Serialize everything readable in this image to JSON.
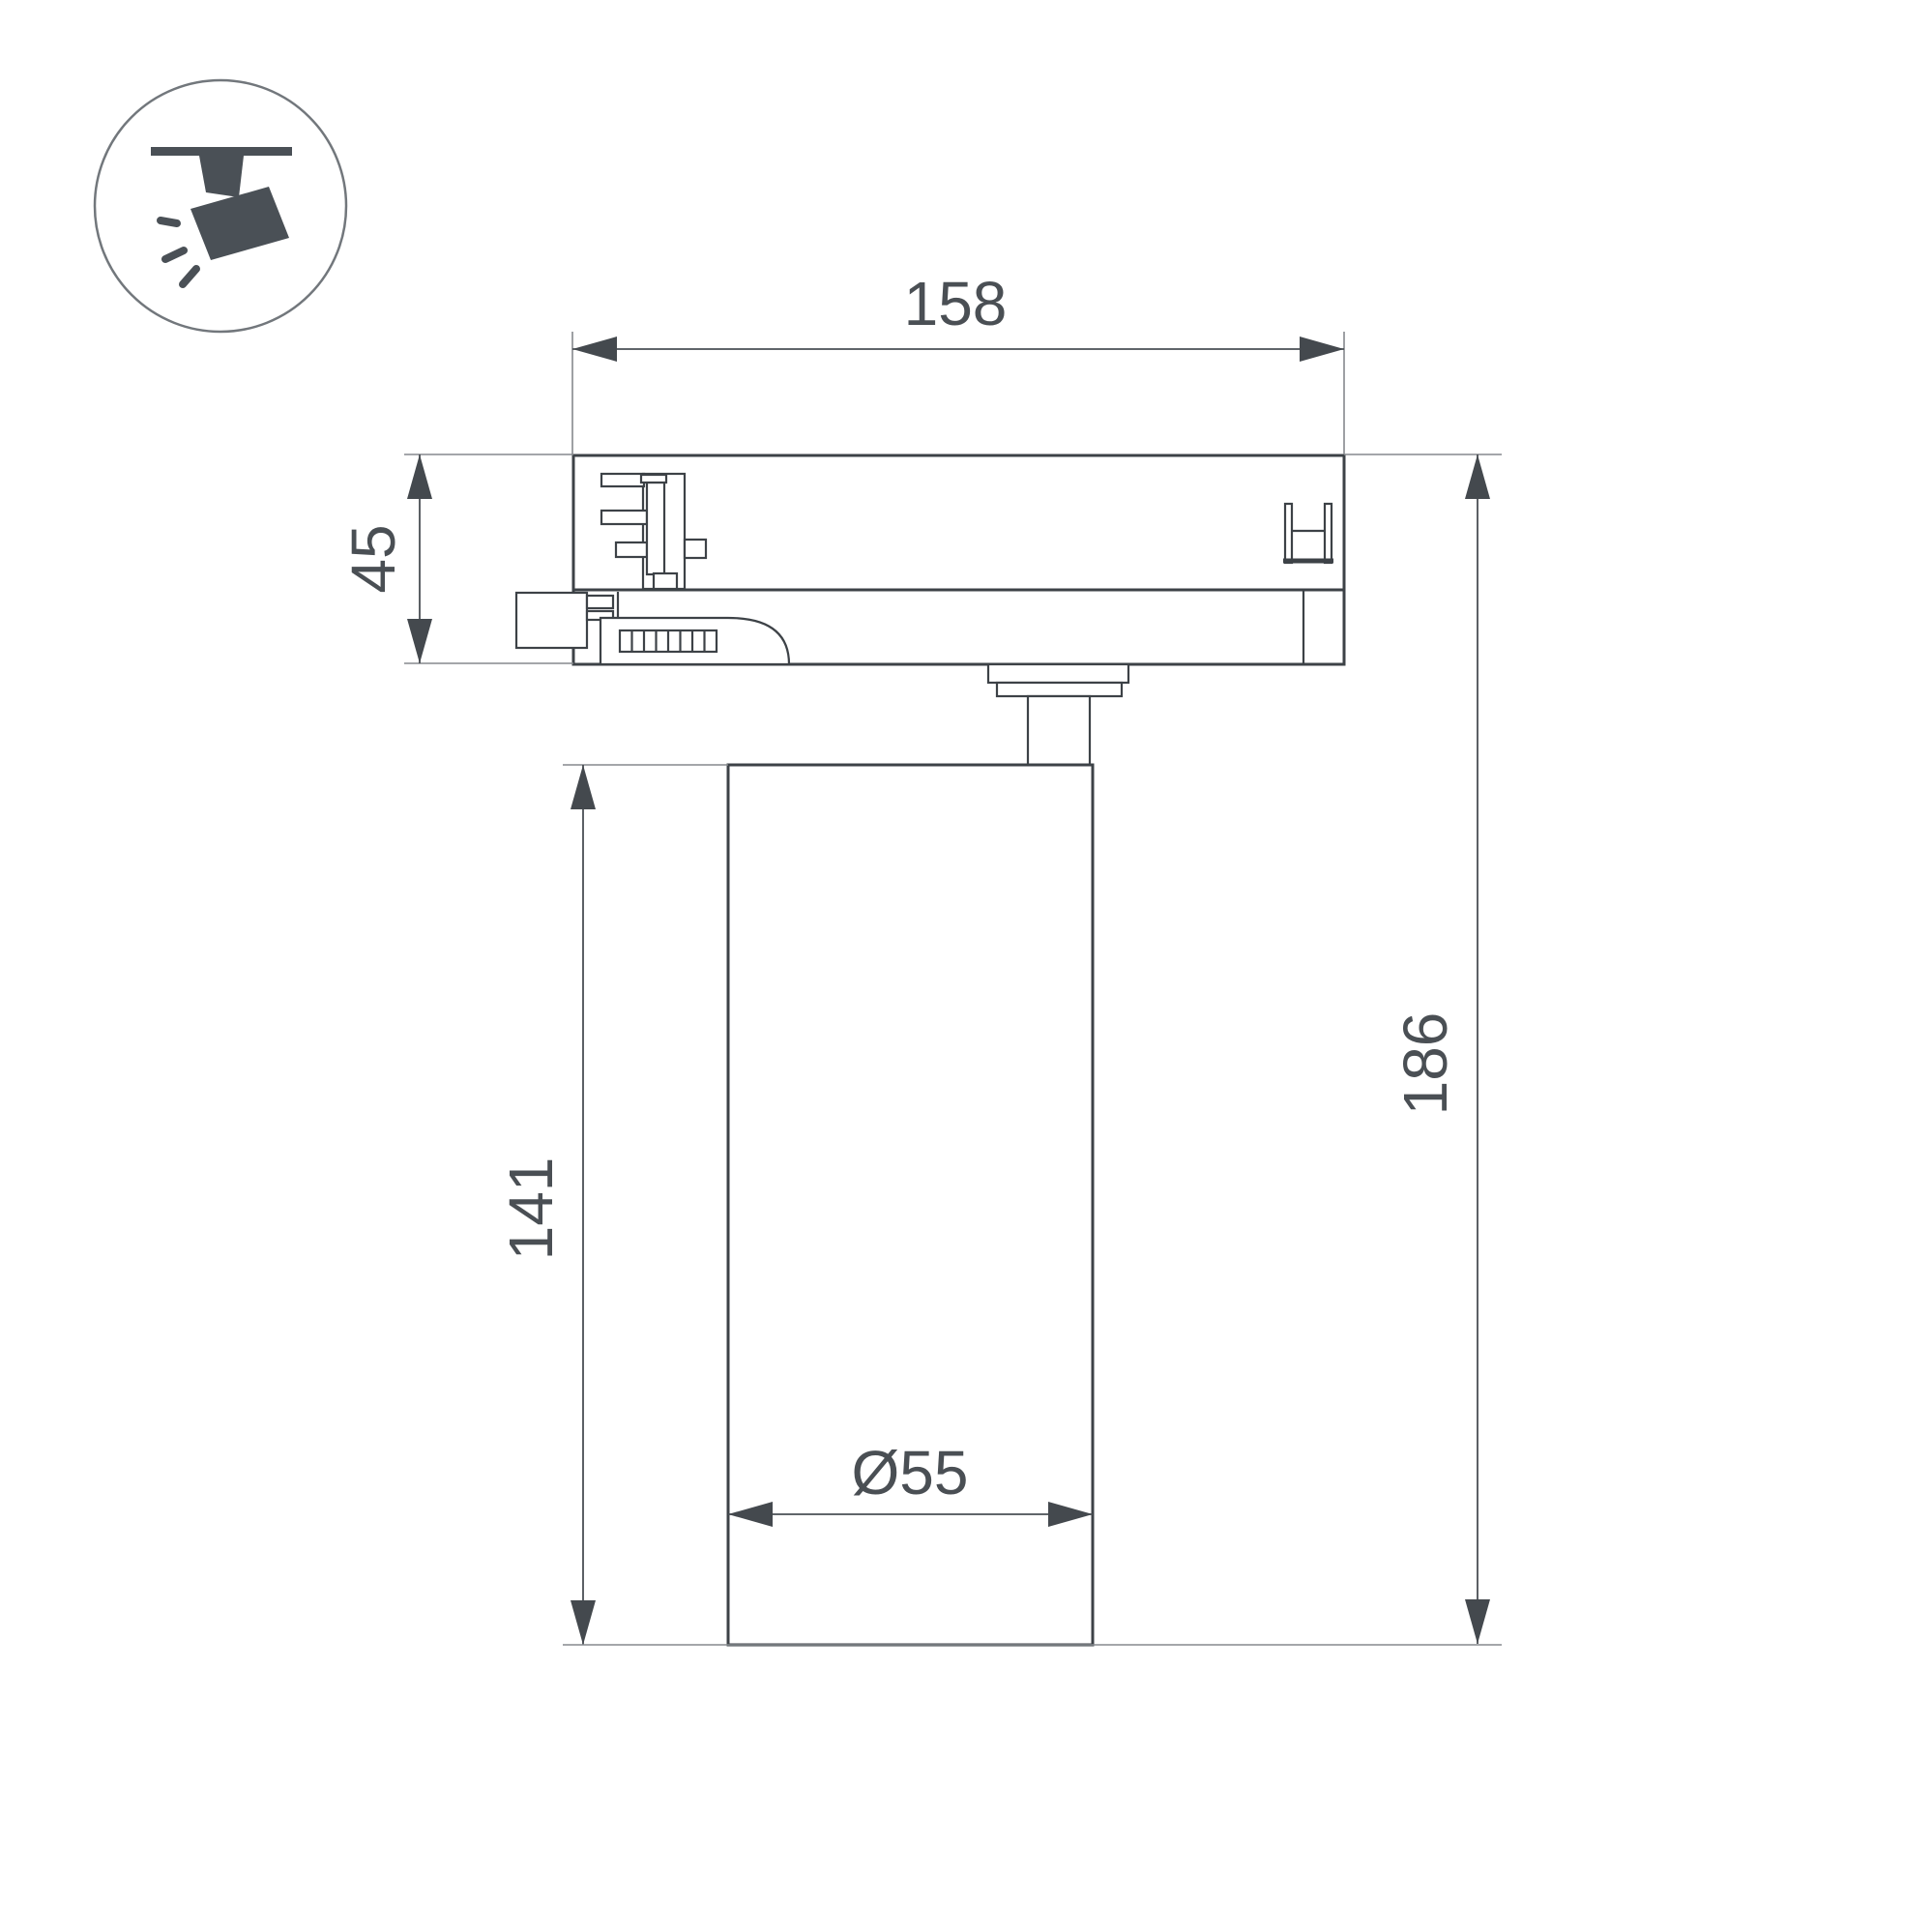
{
  "drawing": {
    "icon": {
      "name": "ceiling-track-spotlight"
    },
    "dimensions": {
      "track_adapter_width": "158",
      "adapter_height": "45",
      "body_height": "141",
      "total_height": "186",
      "body_diameter": "Ø55"
    },
    "colors": {
      "background": "#ffffff",
      "outline": "#3d4247",
      "dimension_line": "#4a4f54",
      "extension_line": "#85898d",
      "dimension_text": "#4a4f54",
      "icon": "#4a5056"
    }
  }
}
